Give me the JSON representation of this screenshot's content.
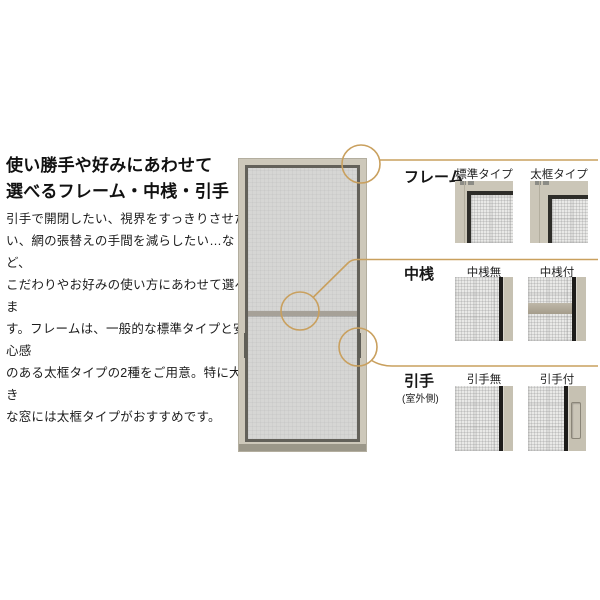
{
  "intro": {
    "heading": "使い勝手や好みにあわせて\n選べるフレーム・中桟・引手",
    "body": "引手で開閉したい、視界をすっきりさせた\nい、網の張替えの手間を減らしたい…など、\nこだわりやお好みの使い方にあわせて選べま\nす。フレームは、一般的な標準タイプと安心感\nのある太框タイプの2種をご用意。特に大き\nな窓には太框タイプがおすすめです。"
  },
  "sections": [
    {
      "label": "フレーム",
      "options": [
        {
          "label": "標準タイプ"
        },
        {
          "label": "太框タイプ"
        }
      ]
    },
    {
      "label": "中桟",
      "options": [
        {
          "label": "中桟無"
        },
        {
          "label": "中桟付"
        }
      ]
    },
    {
      "label": "引手",
      "sublabel": "(室外側)",
      "options": [
        {
          "label": "引手無"
        },
        {
          "label": "引手付"
        }
      ]
    }
  ],
  "colors": {
    "leader_line": "#c9a05e",
    "frame_beige": "#cbc6b8",
    "dark_border": "#2e2d29",
    "door_mesh": "#d6d6d4",
    "text": "#1a1a1a"
  }
}
